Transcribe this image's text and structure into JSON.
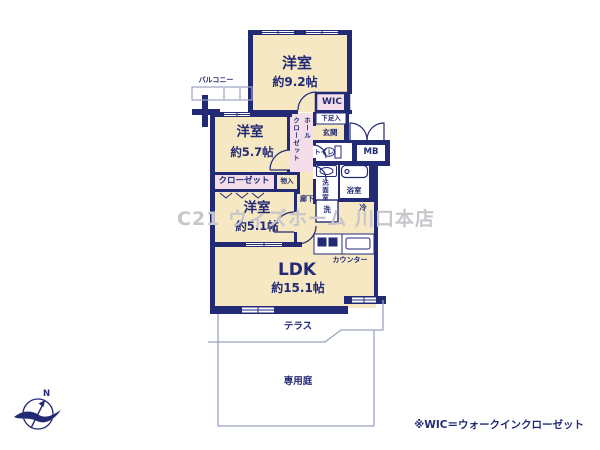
{
  "plan": {
    "rooms": {
      "west1": {
        "name": "洋室",
        "size": "約9.2帖"
      },
      "west2": {
        "name": "洋室",
        "size": "約5.7帖"
      },
      "west3": {
        "name": "洋室",
        "size": "約5.1帖"
      },
      "ldk": {
        "name": "LDK",
        "size": "約15.1帖"
      }
    },
    "labels": {
      "balcony": "バルコニー",
      "wic": "WIC",
      "hall_closet_col1": "ホール",
      "hall_closet_col2": "クローゼット",
      "shoe_box": "下足入",
      "entrance": "玄関",
      "toilet": "トイレ",
      "meter_box": "MB",
      "washroom": "洗面室",
      "bathroom": "浴室",
      "washer": "洗",
      "fridge": "冷",
      "corridor": "廊下",
      "storage": "物入",
      "closet": "クローゼット",
      "counter": "カウンター",
      "terrace": "テラス",
      "garden": "専用庭"
    },
    "compass": {
      "north": "N"
    },
    "watermark": "C21 ウィズホーム 川口本店",
    "footnote": "※WIC＝ウォークインクローゼット",
    "colors": {
      "wall": "#232a75",
      "room": "#f5e8c2",
      "closet": "#f2dde8",
      "thin_line": "#9aa3c0",
      "watermark": "#c6c6cb",
      "background": "#ffffff"
    }
  }
}
